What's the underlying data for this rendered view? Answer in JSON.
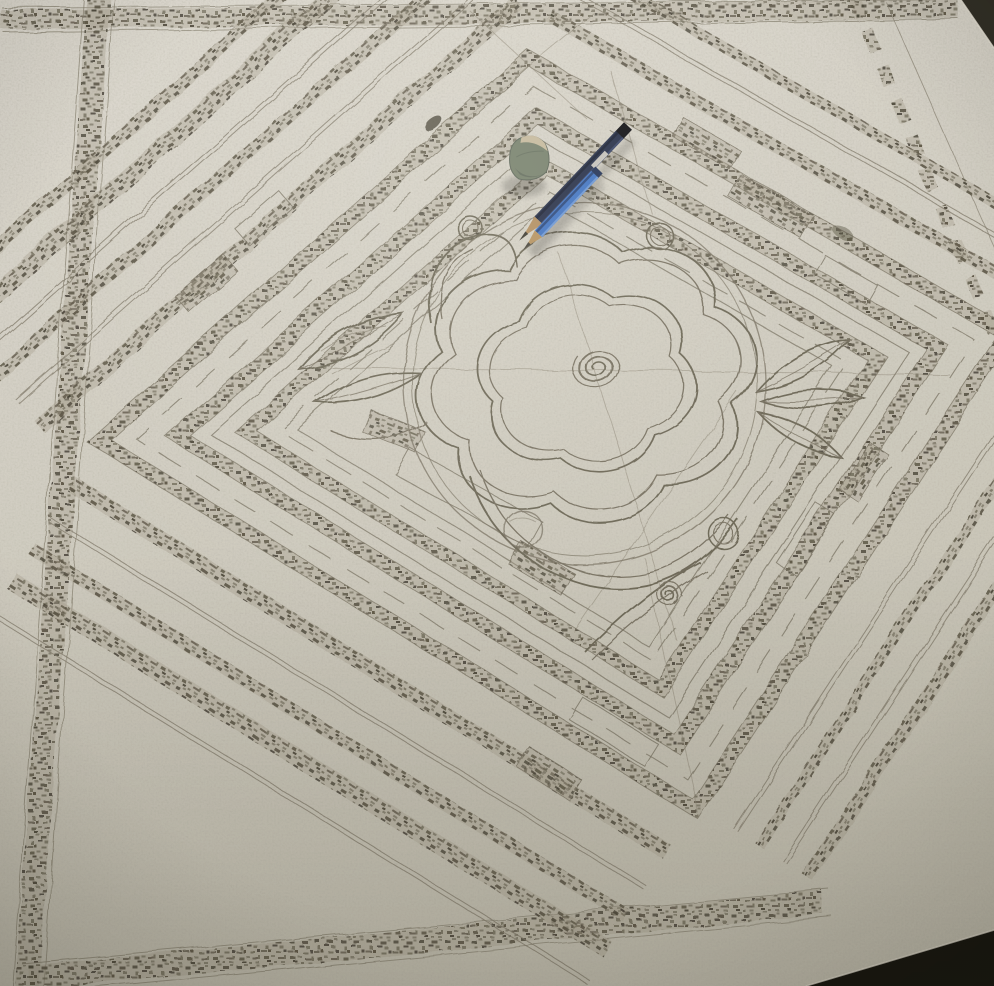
{
  "scene": {
    "alt": "Overhead photo of a large pencil drawing on paper: an ornamental square panel with concentric charcoal-hatched diamond bands, striped corners, and a central rose with a spiral heart and leaf sprigs; a grey-green eraser and two blue pencils rest on the paper near the top",
    "description": "Hand-drawn geometric carpet/panel design in graphite and charcoal on a big off-white sheet lying on a dark table. Nested diamond frames of smudged hatched bands surround a central field with a sketched rose (spiral center, scalloped petals), leaf clusters on either side, small circles at the diamond corners and a scroll flourish below. Diagonal hatched stripes fill the corners, a hatched border runs along the paper edges, and a dashed band follows the right paper edge. Two pencils (dark navy and bright blue) with sharpened tips pointing down-left lie beside a small grey-green eraser."
  },
  "objects": {
    "table": {
      "name": "table-surface",
      "color": "#15130e",
      "corner_top_right_color": "#2c2922",
      "corner_bottom_right_color": "#0b0a06"
    },
    "paper": {
      "name": "paper-sheet",
      "color_top": "#dedad2",
      "color_mid": "#d4d0c6",
      "color_bottom": "#c4c0b3",
      "edge_highlight": "#ece7dc"
    },
    "drawing": {
      "name": "pencil-sketch",
      "line_color": "#6d6759",
      "double_line_color": "#7a7365",
      "faint_line_color": "#8e8779",
      "hatch_color": "#554f40",
      "hatch_dark": "#3e3a2f",
      "hatch_base": "#a79e8f",
      "motifs": [
        "concentric diamond bands",
        "hatched border frame",
        "corner stripes",
        "dashed edge band",
        "brick blocks",
        "central rose with spiral heart",
        "scalloped petals",
        "leaf sprigs",
        "accent circles",
        "scroll flourish",
        "construction lines"
      ]
    },
    "eraser": {
      "name": "eraser",
      "body_color": "#76806d",
      "shade_color": "#5c655a",
      "top_color": "#cabda2"
    },
    "pencil_dark": {
      "name": "navy-pencil",
      "body_color": "#232c48",
      "edge_color": "#161d33",
      "sheen_color": "#3c4970",
      "cap_color": "#0c0c12",
      "band_color": "#d8d4cb",
      "wood_color": "#b28c60",
      "tip_color": "#3a362f"
    },
    "pencil_blue": {
      "name": "blue-pencil",
      "body_color": "#3f72c4",
      "ridge_color": "#27457e",
      "light_color": "#6f9ad9",
      "cap_color": "#1e2f55",
      "wood_color": "#b5915f",
      "tip_color": "#45413a"
    }
  }
}
